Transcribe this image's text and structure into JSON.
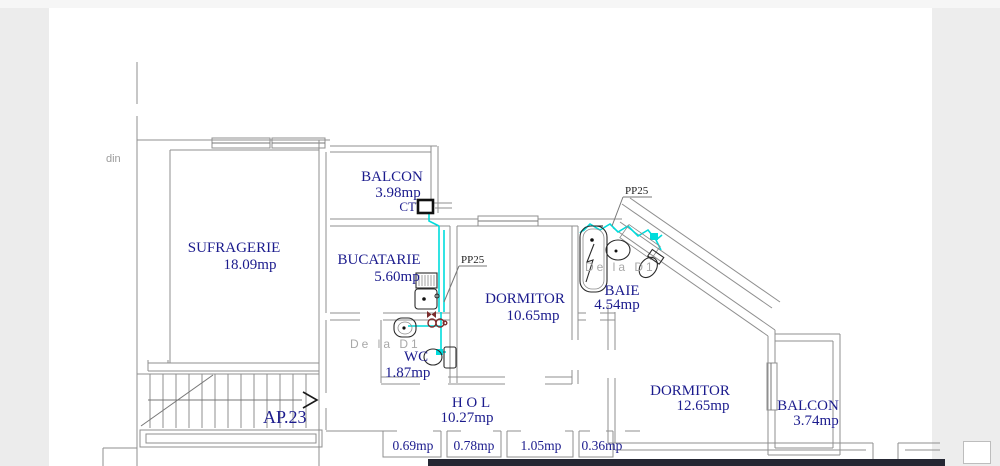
{
  "page": {
    "clipped_text_left": "din"
  },
  "plan": {
    "apartment": "AP.23",
    "labels": {
      "sufragerie": {
        "name": "SUFRAGERIE",
        "area": "18.09mp"
      },
      "balcon_top": {
        "name": "BALCON",
        "area": "3.98mp"
      },
      "bucatarie": {
        "name": "BUCATARIE",
        "area": "5.60mp"
      },
      "dormitor1": {
        "name": "DORMITOR",
        "area": "10.65mp"
      },
      "baie": {
        "name": "BAIE",
        "area": "4.54mp"
      },
      "wc": {
        "name": "WC",
        "area": "1.87mp"
      },
      "hol": {
        "name": "H O L",
        "area": "10.27mp"
      },
      "dormitor2": {
        "name": "DORMITOR",
        "area": "12.65mp"
      },
      "balcon_right": {
        "name": "BALCON",
        "area": "3.74mp"
      }
    },
    "closets": [
      {
        "area": "0.69mp"
      },
      {
        "area": "0.78mp"
      },
      {
        "area": "1.05mp"
      },
      {
        "area": "0.36mp"
      }
    ],
    "annotations": {
      "ct": "CT",
      "pp25_kitchen": "PP25",
      "pp25_bath": "PP25",
      "from_d1_wc": "De la D1",
      "from_d1_bath": "De la D1"
    },
    "colors": {
      "label_navy": "#1b1b8d",
      "pipe_cyan": "#00dcdc",
      "valve_red": "#7b2b2b",
      "wall_gray": "#8f8f8f",
      "muted_gray": "#a8a8a8"
    }
  }
}
